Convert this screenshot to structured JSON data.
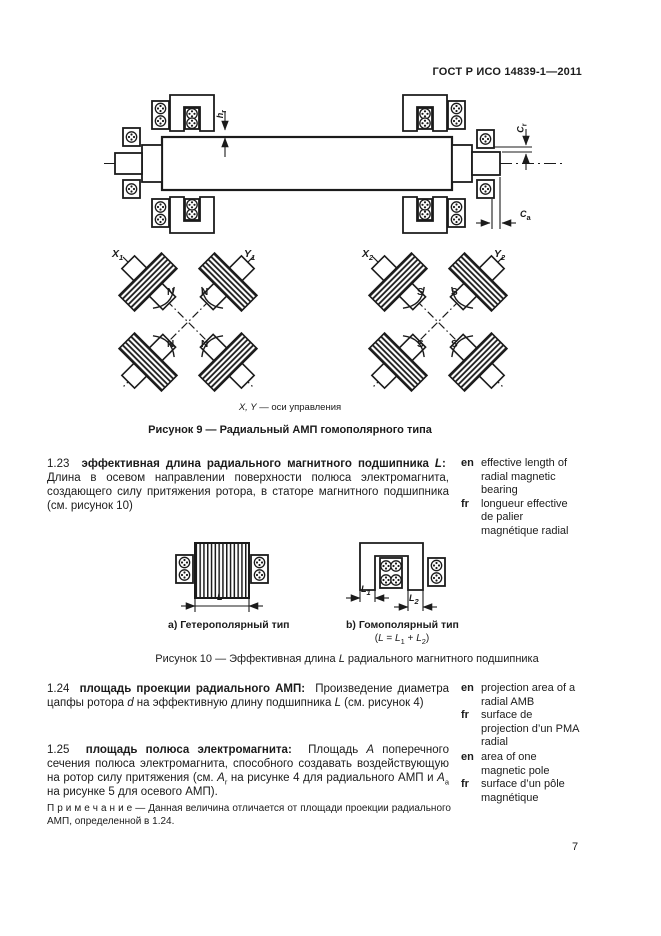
{
  "header": {
    "doc_code": "ГОСТ Р ИСО 14839-1—2011"
  },
  "figure9": {
    "dim_hr": {
      "base": "h",
      "sub": "r"
    },
    "dim_cr": {
      "base": "C",
      "sub": "r"
    },
    "dim_ca": {
      "base": "C",
      "sub": "a"
    },
    "axis_x1": {
      "base": "X",
      "sub": "1"
    },
    "axis_y1": {
      "base": "Y",
      "sub": "1"
    },
    "axis_x2": {
      "base": "X",
      "sub": "2"
    },
    "axis_y2": {
      "base": "Y",
      "sub": "2"
    },
    "poles_left": [
      "N",
      "N",
      "N",
      "N"
    ],
    "poles_right": [
      "S",
      "S",
      "S",
      "S"
    ],
    "legend_runs": [
      {
        "t": "X, Y",
        "st": "i"
      },
      {
        "t": " — оси управления",
        "st": "n"
      }
    ],
    "caption": "Рисунок 9 — Радиальный АМП гомополярного типа"
  },
  "sec123": {
    "runs": [
      {
        "t": "1.23  ",
        "st": "n"
      },
      {
        "t": "эффективная длина радиального магнитного подшипника ",
        "st": "b"
      },
      {
        "t": "L",
        "st": "bi"
      },
      {
        "t": ":",
        "st": "b"
      },
      {
        "t": "  Длина в осевом направлении поверхности полюса электромагнита, создающего силу притяжения ротора, в статоре магнитного подшипника (см. рисунок 10)",
        "st": "n"
      }
    ],
    "en_label": "en",
    "en": "effective length of\nradial magnetic\nbearing",
    "fr_label": "fr",
    "fr": "longueur effective\nde palier\nmagnétique radial"
  },
  "figure10": {
    "label_a": "а) Гетерополярный тип",
    "label_b": "b) Гомополярный тип",
    "formula_runs": [
      {
        "t": "(",
        "st": "n"
      },
      {
        "t": "L",
        "st": "i"
      },
      {
        "t": " = ",
        "st": "n"
      },
      {
        "t": "L",
        "st": "i"
      },
      {
        "t": "1",
        "st": "sub"
      },
      {
        "t": " + ",
        "st": "n"
      },
      {
        "t": "L",
        "st": "i"
      },
      {
        "t": "2",
        "st": "sub"
      },
      {
        "t": ")",
        "st": "n"
      }
    ],
    "dim_l": {
      "base": "L",
      "sub": ""
    },
    "dim_l1": {
      "base": "L",
      "sub": "1"
    },
    "dim_l2": {
      "base": "L",
      "sub": "2"
    },
    "caption_runs": [
      {
        "t": "Рисунок 10 — Эффективная длина ",
        "st": "n"
      },
      {
        "t": "L",
        "st": "i"
      },
      {
        "t": " радиального магнитного подшипника",
        "st": "n"
      }
    ]
  },
  "sec124": {
    "runs": [
      {
        "t": "1.24  ",
        "st": "n"
      },
      {
        "t": "площадь проекции радиального АМП:",
        "st": "b"
      },
      {
        "t": "  Произведение диаметра цапфы ротора ",
        "st": "n"
      },
      {
        "t": "d",
        "st": "i"
      },
      {
        "t": " на эффективную длину подшипника ",
        "st": "n"
      },
      {
        "t": "L",
        "st": "i"
      },
      {
        "t": " (см. рисунок 4)",
        "st": "n"
      }
    ],
    "en_label": "en",
    "en": "projection area of a\nradial AMB",
    "fr_label": "fr",
    "fr": "surface de\nprojection d’un PMA\nradial"
  },
  "sec125": {
    "runs": [
      {
        "t": "1.25  ",
        "st": "n"
      },
      {
        "t": "площадь полюса электромагнита:",
        "st": "b"
      },
      {
        "t": "  Площадь ",
        "st": "n"
      },
      {
        "t": "A",
        "st": "i"
      },
      {
        "t": " поперечного сечения полюса электромагнита, способного создавать воздействующую на ротор силу притяжения (см. ",
        "st": "n"
      },
      {
        "t": "A",
        "st": "i"
      },
      {
        "t": "r",
        "st": "sub"
      },
      {
        "t": " на рисунке 4 для радиального АМП и ",
        "st": "n"
      },
      {
        "t": "A",
        "st": "i"
      },
      {
        "t": "a",
        "st": "sub"
      },
      {
        "t": " на рисунке 5 для осевого АМП).",
        "st": "n"
      }
    ],
    "note_runs": [
      {
        "t": "П р и м е ч а н и е",
        "st": "n"
      },
      {
        "t": " — Данная величина отличается от площади проекции радиального АМП, определенной в 1.24.",
        "st": "n"
      }
    ],
    "en_label": "en",
    "en": "area of one\nmagnetic pole",
    "fr_label": "fr",
    "fr": "surface d’un pôle\nmagnétique"
  },
  "footer": {
    "page_number": "7"
  }
}
